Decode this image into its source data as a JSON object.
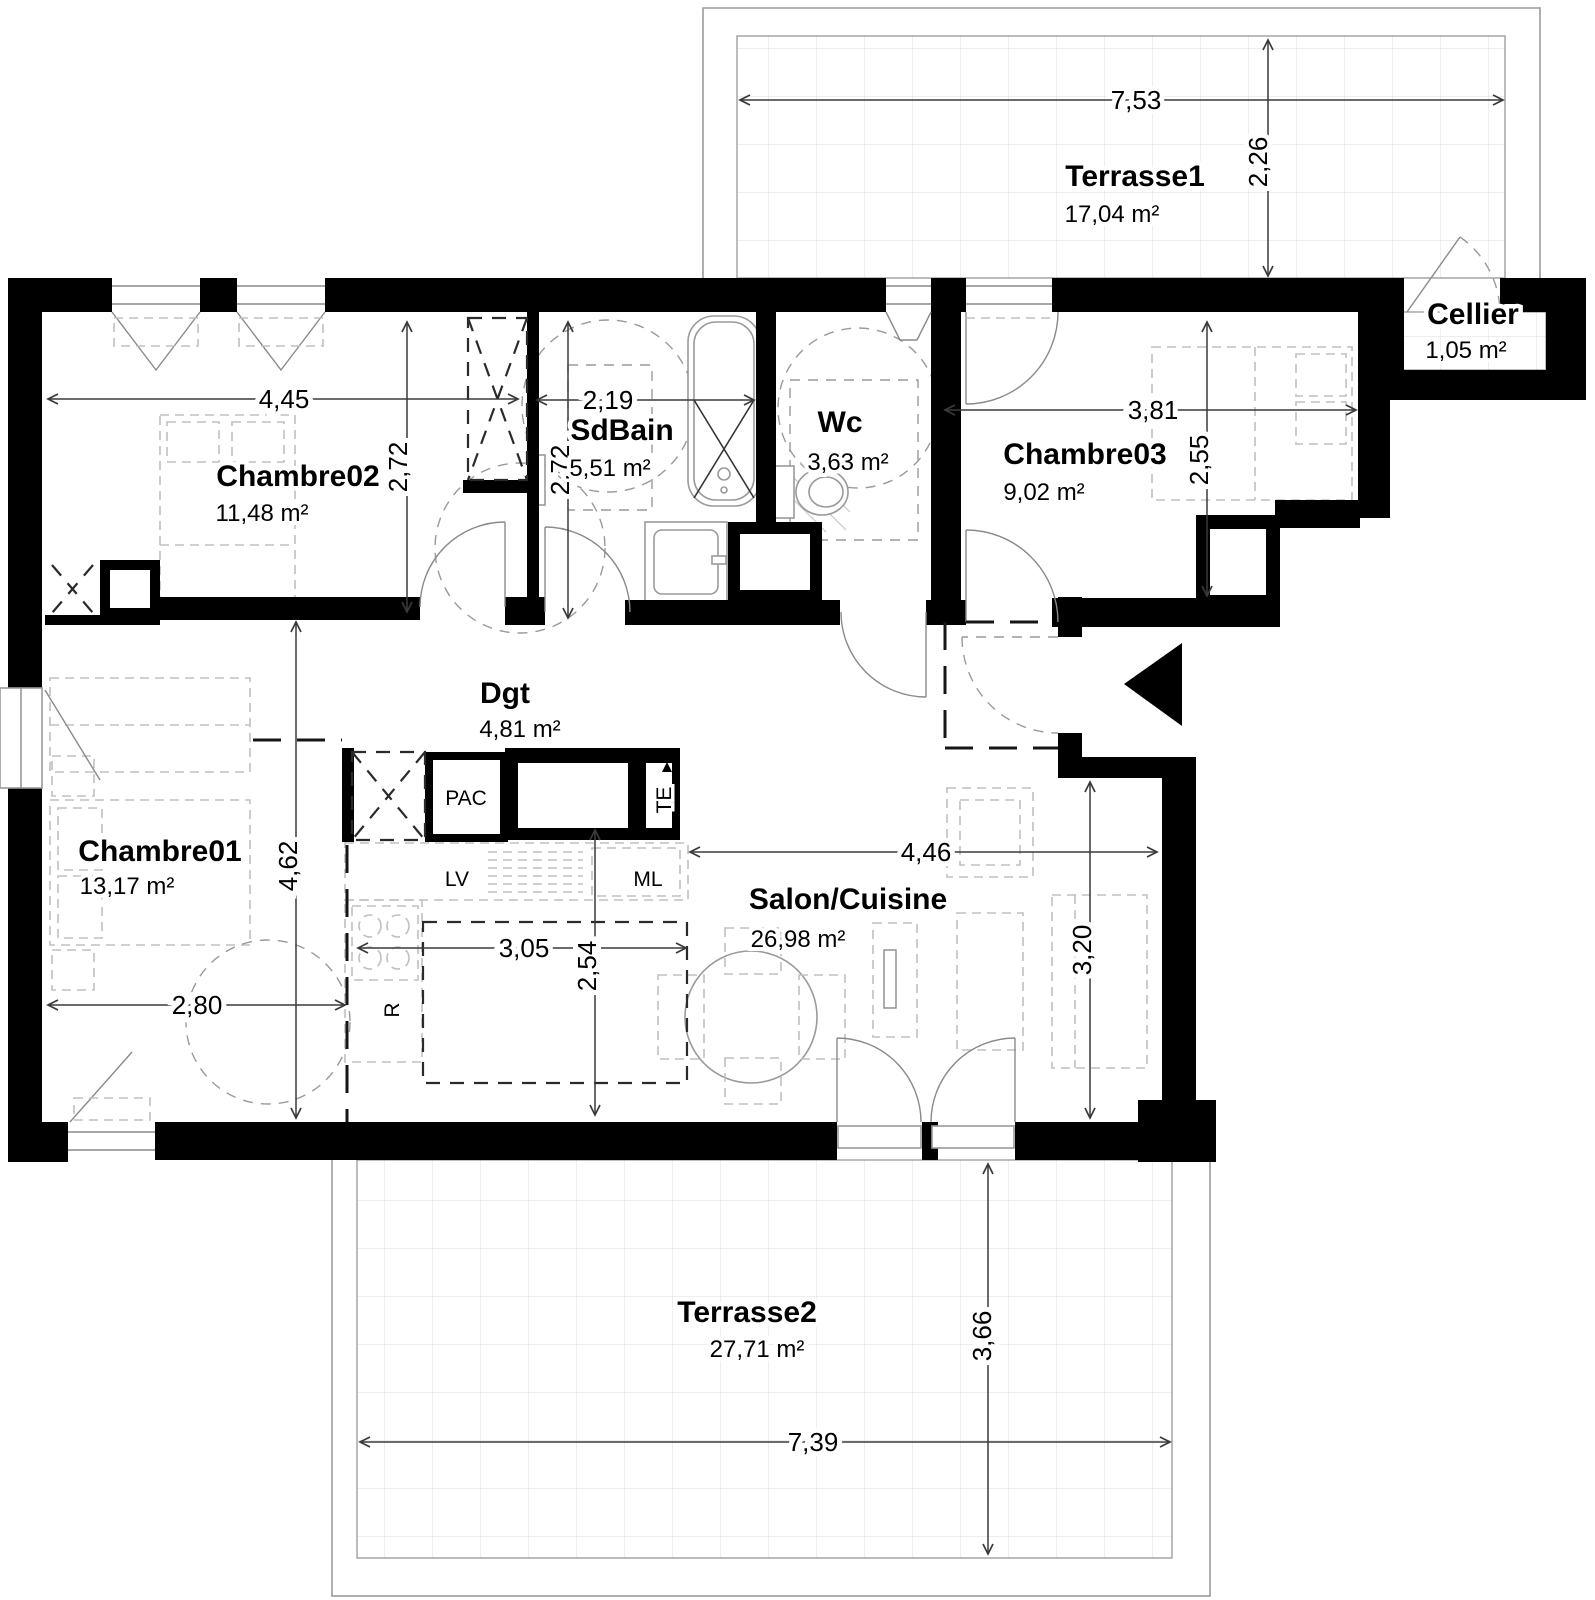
{
  "plan": {
    "rooms": [
      {
        "id": "terrasse1",
        "name": "Terrasse1",
        "area": "17,04 m²"
      },
      {
        "id": "cellier",
        "name": "Cellier",
        "area": "1,05 m²"
      },
      {
        "id": "chambre02",
        "name": "Chambre02",
        "area": "11,48 m²"
      },
      {
        "id": "sdbain",
        "name": "SdBain",
        "area": "5,51 m²"
      },
      {
        "id": "wc",
        "name": "Wc",
        "area": "3,63 m²"
      },
      {
        "id": "chambre03",
        "name": "Chambre03",
        "area": "9,02 m²"
      },
      {
        "id": "chambre01",
        "name": "Chambre01",
        "area": "13,17 m²"
      },
      {
        "id": "dgt",
        "name": "Dgt",
        "area": "4,81 m²"
      },
      {
        "id": "salon_cuisine",
        "name": "Salon/Cuisine",
        "area": "26,98 m²"
      },
      {
        "id": "terrasse2",
        "name": "Terrasse2",
        "area": "27,71 m²"
      }
    ],
    "equipment": {
      "pac": "PAC",
      "lv": "LV",
      "ml": "ML",
      "fridge": "R",
      "te": "TE"
    },
    "dimensions": {
      "terrasse1_width": "7,53",
      "terrasse1_depth": "2,26",
      "chambre02_width": "4,45",
      "chambre02_depth": "2,72",
      "sdbain_width": "2,19",
      "sdbain_depth": "2,72",
      "chambre03_width": "3,81",
      "chambre03_depth": "2,55",
      "chambre01_width": "2,80",
      "chambre01_depth": "4,62",
      "cuisine_width": "3,05",
      "cuisine_depth": "2,54",
      "salon_width": "4,46",
      "salon_depth": "3,20",
      "terrasse2_width": "7,39",
      "terrasse2_depth": "3,66"
    },
    "colors": {
      "wall": "#000000",
      "grid": "#d9d9d9",
      "furniture": "#c0c0c0",
      "dimension": "#3a3a3a"
    }
  }
}
